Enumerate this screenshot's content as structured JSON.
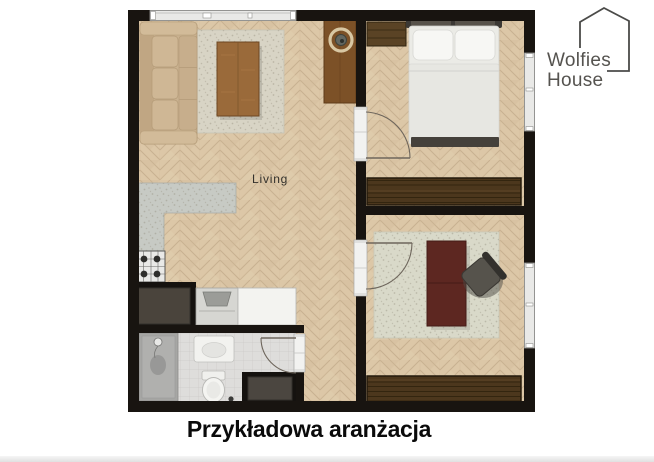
{
  "caption": {
    "text": "Przykładowa aranżacja"
  },
  "logo": {
    "line1": "Wolfies",
    "line2": "House"
  },
  "plan": {
    "room_label": "Living",
    "colors": {
      "wall": "#181410",
      "floor_wood": "#dcc7a7",
      "floor_wood_line": "#c8b190",
      "bathroom_tile": "#dedddb",
      "rug_living": "#d8d4c5",
      "rug_office": "#d9d9c9",
      "kitchen_counter": "#c7cac4",
      "wardrobe_wood": "#4c371d",
      "console_wood": "#7c5127",
      "coffee_table_wood": "#9a6a3a",
      "sofa": "#c9b18f",
      "bed_linen": "#ebebe6",
      "desk_wood": "#5d2721",
      "appliance_dark": "#4a443c",
      "window_frame": "#e9e9e7",
      "door_arc": "#6e665c"
    },
    "rooms": [
      {
        "name": "living-room",
        "label": "Living",
        "furniture": [
          "sofa",
          "area-rug",
          "coffee-table",
          "console-with-round-decor",
          "l-shaped-counter",
          "stove",
          "fridge",
          "sink-cabinet",
          "white-counter"
        ]
      },
      {
        "name": "bedroom",
        "furniture": [
          "double-bed",
          "headboard",
          "pillows",
          "bedside-dresser",
          "wardrobe",
          "window",
          "door"
        ]
      },
      {
        "name": "office",
        "furniture": [
          "desk",
          "office-chair",
          "area-rug",
          "wardrobe",
          "window",
          "door"
        ]
      },
      {
        "name": "bathroom",
        "furniture": [
          "shower",
          "washbasin",
          "toilet",
          "washer-niche",
          "door"
        ]
      },
      {
        "name": "hallway",
        "furniture": []
      }
    ]
  }
}
